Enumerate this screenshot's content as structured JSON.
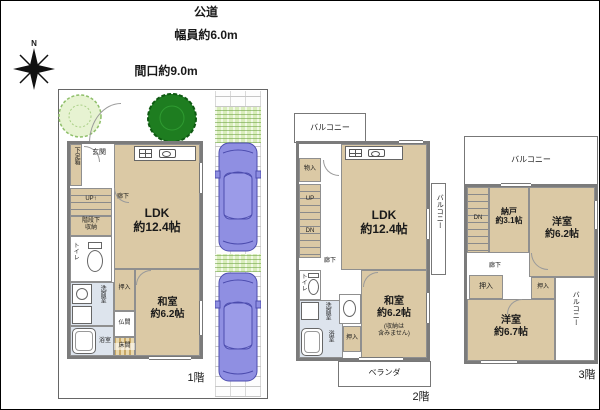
{
  "site": {
    "road": "公道",
    "road_width": "幅員約6.0m",
    "frontage": "間口約9.0m",
    "north": "N"
  },
  "f1": {
    "label": "1階",
    "genkan": "玄関",
    "shoe_box": "下足箱",
    "up": "UP↑",
    "stair_storage_l1": "階段下",
    "stair_storage_l2": "収納",
    "toilet": "トイレ",
    "hallway": "廊下",
    "washroom": "洗面室",
    "bath": "浴室",
    "closet": "押入",
    "butsuma": "仏間",
    "tokonoma": "床間",
    "ldk_name": "LDK",
    "ldk_size": "約12.4帖",
    "washitsu_name": "和室",
    "washitsu_size": "約6.2帖"
  },
  "f2": {
    "label": "2階",
    "balcony": "バルコニー",
    "balcony_right": "バルコニー",
    "veranda": "ベランダ",
    "storage": "物入",
    "up": "UP",
    "dn": "DN",
    "hallway": "廊下",
    "toilet": "トイレ",
    "washroom": "洗面室",
    "bath": "浴室",
    "closet": "押入",
    "ldk_name": "LDK",
    "ldk_size": "約12.4帖",
    "washitsu_name": "和室",
    "washitsu_size": "約6.2帖",
    "washitsu_note1": "(収納は",
    "washitsu_note2": "含みません)"
  },
  "f3": {
    "label": "3階",
    "balcony_top": "バルコニー",
    "balcony_right": "バルコニー",
    "dn": "DN",
    "hallway": "廊下",
    "closet_left": "押入",
    "closet_right": "押入",
    "nando_name": "納戸",
    "nando_size": "約3.1帖",
    "yoshitsu1_name": "洋室",
    "yoshitsu1_size": "約6.2帖",
    "yoshitsu2_name": "洋室",
    "yoshitsu2_size": "約6.7帖"
  },
  "colors": {
    "room_fill": "#dbc9a5",
    "wet_fill": "#dde4ed",
    "wall": "#7b7b7b",
    "grass": "#d9edbb",
    "tree": "#1e7d20",
    "car": "#8f8fe2"
  }
}
